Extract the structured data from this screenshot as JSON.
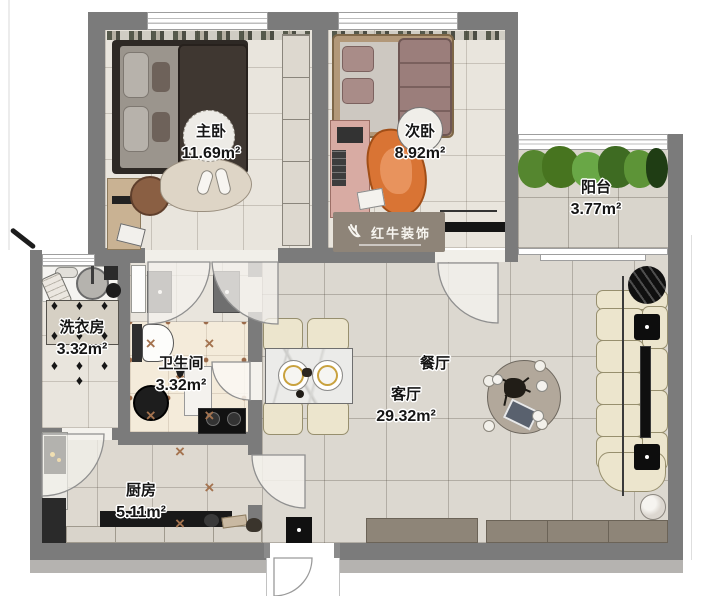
{
  "rooms": [
    {
      "id": "master-bedroom",
      "label": "主卧",
      "area": "11.69m²"
    },
    {
      "id": "second-bedroom",
      "label": "次卧",
      "area": "8.92m²"
    },
    {
      "id": "balcony",
      "label": "阳台",
      "area": "3.77m²"
    },
    {
      "id": "laundry-room",
      "label": "洗衣房",
      "area": "3.32m²"
    },
    {
      "id": "bathroom",
      "label": "卫生间",
      "area": "3.32m²"
    },
    {
      "id": "dining-room",
      "label": "餐厅",
      "area": ""
    },
    {
      "id": "living-room",
      "label": "客厅",
      "area": "29.32m²"
    },
    {
      "id": "kitchen",
      "label": "厨房",
      "area": "5.11m²"
    }
  ],
  "watermark": {
    "text": "红牛装饰",
    "logo": "bull-swoosh-icon"
  },
  "patterns": {
    "bathroom": {
      "glyph": "×",
      "rows": 3,
      "cols": 3
    },
    "laundry": {
      "glyph": "♦",
      "rows": 3,
      "cols": 4
    }
  },
  "colors": {
    "wall": "#7b7b7b",
    "bedroom_floor": "#e9e5dd",
    "living_floor": "#dcd8d0",
    "bath_floor": "#f4ebda",
    "bath_accent": "#a4734f",
    "sofa": "#ece5cd",
    "plant_green": "#55862f",
    "chair_orange": "#d97434",
    "cabinet_taupe": "#8e8578"
  }
}
